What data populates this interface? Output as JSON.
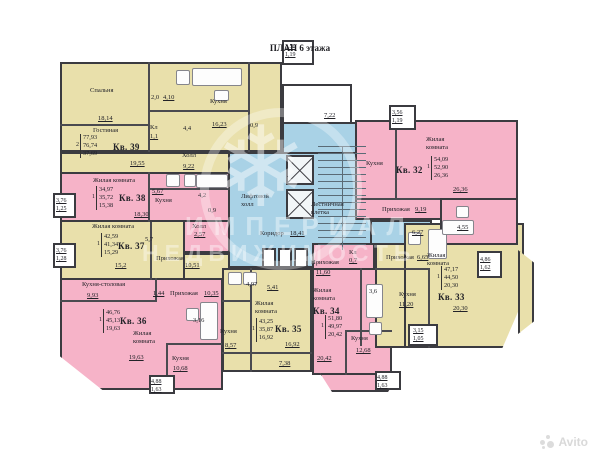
{
  "title": "ПЛАН 6 этажа",
  "watermark": {
    "logo": "snowflake-icon",
    "line1": "ИМПЕРИАЛ",
    "line2": "НЕДВИЖИМОСТЬ",
    "brand": "Avito"
  },
  "colors": {
    "room_yellow": "#e9e0ab",
    "room_pink": "#f6b3c8",
    "core_blue": "#a9d2e6",
    "wall": "#3b3b40"
  },
  "plan": {
    "labels": [
      {
        "t": "Спальня",
        "c": "n",
        "x": 90,
        "y": 87
      },
      {
        "t": "18,14",
        "c": "a",
        "x": 98,
        "y": 115
      },
      {
        "t": "2,0",
        "c": "s",
        "x": 151,
        "y": 94
      },
      {
        "t": "4,10",
        "c": "a",
        "x": 163,
        "y": 94
      },
      {
        "t": "Кухня",
        "c": "n",
        "x": 210,
        "y": 98
      },
      {
        "t": "16,23",
        "c": "a",
        "x": 212,
        "y": 121
      },
      {
        "t": "Гостиная",
        "c": "n",
        "x": 93,
        "y": 127
      },
      {
        "t": "19,55",
        "c": "a",
        "x": 130,
        "y": 160
      },
      {
        "t": "Кв. 39",
        "c": "k",
        "x": 113,
        "y": 142
      },
      {
        "lines": [
          "77,93",
          "76,74",
          "37,69"
        ],
        "pre": "2",
        "c": "t",
        "x": 76,
        "y": 134
      },
      {
        "t": "Кл",
        "c": "s",
        "x": 150,
        "y": 124
      },
      {
        "t": "1,1",
        "c": "a",
        "x": 150,
        "y": 133
      },
      {
        "t": "4,4",
        "c": "s",
        "x": 183,
        "y": 125
      },
      {
        "t": "0,9",
        "c": "s",
        "x": 250,
        "y": 122
      },
      {
        "t": "Холл",
        "c": "n",
        "x": 182,
        "y": 152
      },
      {
        "t": "9,22",
        "c": "a",
        "x": 183,
        "y": 163
      },
      {
        "t": "Жилая комната",
        "c": "n",
        "x": 93,
        "y": 177
      },
      {
        "lines": [
          "34,97",
          "35,72",
          "15,38"
        ],
        "pre": "1",
        "c": "t",
        "x": 92,
        "y": 186
      },
      {
        "t": "Кв. 38",
        "c": "k",
        "x": 119,
        "y": 193
      },
      {
        "t": "18,30",
        "c": "a",
        "x": 134,
        "y": 211
      },
      {
        "t": "5,67",
        "c": "a",
        "x": 152,
        "y": 188
      },
      {
        "t": "Кухня",
        "c": "n",
        "x": 155,
        "y": 197
      },
      {
        "t": "4,2",
        "c": "s",
        "x": 198,
        "y": 192
      },
      {
        "t": "0,9",
        "c": "s",
        "x": 208,
        "y": 207
      },
      {
        "t": "Холл",
        "c": "n",
        "x": 192,
        "y": 223
      },
      {
        "t": "2,57",
        "c": "a",
        "x": 194,
        "y": 231
      },
      {
        "lines": [
          "3,76",
          "1,25"
        ],
        "c": "b",
        "x": 56,
        "y": 197
      },
      {
        "t": "Жилая комната",
        "c": "n",
        "x": 92,
        "y": 223
      },
      {
        "lines": [
          "42,59",
          "41,34",
          "15,29"
        ],
        "pre": "1",
        "c": "t",
        "x": 97,
        "y": 233
      },
      {
        "t": "Кв. 37",
        "c": "k",
        "x": 118,
        "y": 241
      },
      {
        "t": "5,7",
        "c": "s",
        "x": 145,
        "y": 236
      },
      {
        "t": "Прихожая",
        "c": "n",
        "x": 156,
        "y": 255
      },
      {
        "t": "15,2",
        "c": "a",
        "x": 115,
        "y": 262
      },
      {
        "t": "10,51",
        "c": "a",
        "x": 185,
        "y": 262
      },
      {
        "lines": [
          "3,76",
          "1,28"
        ],
        "c": "b",
        "x": 56,
        "y": 247
      },
      {
        "t": "Кухня-столовая",
        "c": "n",
        "x": 82,
        "y": 281
      },
      {
        "t": "9,93",
        "c": "a",
        "x": 87,
        "y": 292
      },
      {
        "t": "1,44",
        "c": "a",
        "x": 153,
        "y": 290
      },
      {
        "t": "Прихожая",
        "c": "n",
        "x": 170,
        "y": 290
      },
      {
        "t": "10,35",
        "c": "a",
        "x": 204,
        "y": 290
      },
      {
        "lines": [
          "46,76",
          "45,13",
          "19,63"
        ],
        "pre": "1",
        "c": "t",
        "x": 99,
        "y": 309
      },
      {
        "t": "Кв. 36",
        "c": "k",
        "x": 120,
        "y": 316
      },
      {
        "t": "Жилая\nкомната",
        "c": "n",
        "x": 133,
        "y": 330
      },
      {
        "t": "19,63",
        "c": "a",
        "x": 129,
        "y": 354
      },
      {
        "t": "3,16",
        "c": "s",
        "x": 193,
        "y": 317
      },
      {
        "t": "Кухня",
        "c": "n",
        "x": 172,
        "y": 355
      },
      {
        "t": "10,68",
        "c": "a",
        "x": 173,
        "y": 365
      },
      {
        "lines": [
          "4,88",
          "1,63"
        ],
        "c": "b",
        "x": 151,
        "y": 378
      },
      {
        "t": "4,97",
        "c": "s",
        "x": 246,
        "y": 281
      },
      {
        "t": "5,41",
        "c": "a",
        "x": 267,
        "y": 284
      },
      {
        "t": "Жилая\nкомната",
        "c": "n",
        "x": 255,
        "y": 300
      },
      {
        "lines": [
          "43,25",
          "35,87",
          "16,92"
        ],
        "pre": "1",
        "c": "t",
        "x": 252,
        "y": 318
      },
      {
        "t": "Кв. 35",
        "c": "k",
        "x": 275,
        "y": 324
      },
      {
        "t": "Кухня",
        "c": "n",
        "x": 220,
        "y": 328
      },
      {
        "t": "8,57",
        "c": "a",
        "x": 225,
        "y": 342
      },
      {
        "t": "16,92",
        "c": "a",
        "x": 285,
        "y": 341
      },
      {
        "t": "7,38",
        "c": "a",
        "x": 279,
        "y": 360
      },
      {
        "t": "Прихожая",
        "c": "n",
        "x": 311,
        "y": 259
      },
      {
        "t": "11,60",
        "c": "a",
        "x": 316,
        "y": 269
      },
      {
        "t": "Кл",
        "c": "s",
        "x": 349,
        "y": 249
      },
      {
        "t": "0,7",
        "c": "a",
        "x": 349,
        "y": 257
      },
      {
        "t": "Жилая\nкомната",
        "c": "n",
        "x": 313,
        "y": 287
      },
      {
        "t": "Кв. 34",
        "c": "k",
        "x": 313,
        "y": 306
      },
      {
        "lines": [
          "51,80",
          "49,97",
          "20,42"
        ],
        "pre": "1",
        "c": "t",
        "x": 321,
        "y": 315
      },
      {
        "t": "3,6",
        "c": "s",
        "x": 369,
        "y": 288
      },
      {
        "t": "Кухня",
        "c": "n",
        "x": 351,
        "y": 335
      },
      {
        "t": "12,68",
        "c": "a",
        "x": 356,
        "y": 347
      },
      {
        "t": "20,42",
        "c": "a",
        "x": 317,
        "y": 355
      },
      {
        "lines": [
          "4,88",
          "1,63"
        ],
        "c": "b",
        "x": 377,
        "y": 374
      },
      {
        "t": "6,27",
        "c": "a",
        "x": 412,
        "y": 229
      },
      {
        "t": "Прихожая",
        "c": "n",
        "x": 386,
        "y": 254
      },
      {
        "t": "6,65",
        "c": "a",
        "x": 417,
        "y": 254
      },
      {
        "t": "Жилая\nкомната",
        "c": "n",
        "x": 427,
        "y": 252
      },
      {
        "lines": [
          "47,17",
          "44,50",
          "20,30"
        ],
        "pre": "1",
        "c": "t",
        "x": 437,
        "y": 266
      },
      {
        "t": "Кв. 33",
        "c": "k",
        "x": 438,
        "y": 292
      },
      {
        "t": "Кухня",
        "c": "n",
        "x": 399,
        "y": 291
      },
      {
        "t": "11,20",
        "c": "a",
        "x": 399,
        "y": 301
      },
      {
        "t": "20,30",
        "c": "a",
        "x": 453,
        "y": 305
      },
      {
        "lines": [
          "4,86",
          "1,62"
        ],
        "c": "b",
        "x": 480,
        "y": 256
      },
      {
        "lines": [
          "3,15",
          "1,05"
        ],
        "c": "b",
        "x": 413,
        "y": 327
      },
      {
        "t": "Жилая\nкомната",
        "c": "n",
        "x": 426,
        "y": 136
      },
      {
        "t": "Кв. 32",
        "c": "k",
        "x": 396,
        "y": 165
      },
      {
        "lines": [
          "54,09",
          "52,90",
          "26,36"
        ],
        "pre": "1",
        "c": "t",
        "x": 427,
        "y": 156
      },
      {
        "t": "26,36",
        "c": "a",
        "x": 453,
        "y": 186
      },
      {
        "t": "Кухня",
        "c": "n",
        "x": 366,
        "y": 160
      },
      {
        "t": "Прихожая",
        "c": "n",
        "x": 382,
        "y": 206
      },
      {
        "t": "9,19",
        "c": "a",
        "x": 415,
        "y": 206
      },
      {
        "t": "4,55",
        "c": "a",
        "x": 457,
        "y": 224
      },
      {
        "lines": [
          "3,56",
          "1,19"
        ],
        "c": "b",
        "x": 392,
        "y": 109
      },
      {
        "t": "7,22",
        "c": "a",
        "x": 324,
        "y": 112
      },
      {
        "t": "Коридор",
        "c": "n",
        "x": 260,
        "y": 230
      },
      {
        "t": "18,41",
        "c": "a",
        "x": 290,
        "y": 230
      },
      {
        "t": "Лифтовой\nхолл",
        "c": "n",
        "x": 241,
        "y": 193
      },
      {
        "t": "Лестничная\nклетка",
        "c": "n",
        "x": 311,
        "y": 201
      },
      {
        "lines": [
          "3,56",
          "1,19"
        ],
        "c": "b",
        "x": 285,
        "y": 43
      }
    ]
  }
}
